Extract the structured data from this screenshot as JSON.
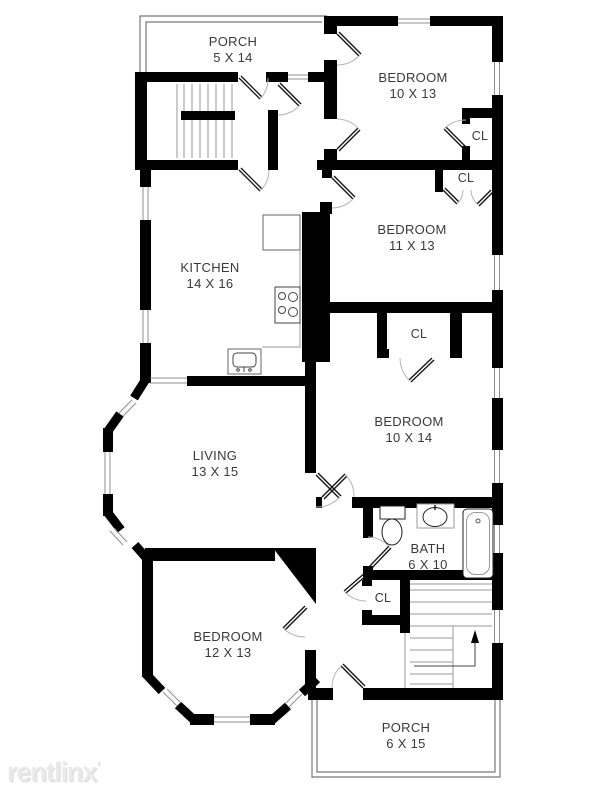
{
  "watermark": {
    "text": "rentlinx",
    "mark": "’"
  },
  "colors": {
    "wall": "#000000",
    "thin_line": "#8f8f8f",
    "door_arc": "#b5b5b5",
    "label_text": "#3a3a3a",
    "watermark_text": "#e9e9e9"
  },
  "rooms": {
    "porch_top": {
      "name": "PORCH",
      "dims": "5 X 14"
    },
    "bedroom_top": {
      "name": "BEDROOM",
      "dims": "10 X 13"
    },
    "bedroom_mid": {
      "name": "BEDROOM",
      "dims": "11 X 13"
    },
    "kitchen": {
      "name": "KITCHEN",
      "dims": "14 X 16"
    },
    "bedroom_right": {
      "name": "BEDROOM",
      "dims": "10 X 14"
    },
    "living": {
      "name": "LIVING",
      "dims": "13 X 15"
    },
    "bath": {
      "name": "BATH",
      "dims": "6 X 10"
    },
    "bedroom_bottom": {
      "name": "BEDROOM",
      "dims": "12 X 13"
    },
    "porch_bottom": {
      "name": "PORCH",
      "dims": "6 X 15"
    }
  },
  "closets": [
    {
      "label": "CL"
    },
    {
      "label": "CL"
    },
    {
      "label": "CL"
    },
    {
      "label": "CL"
    }
  ]
}
